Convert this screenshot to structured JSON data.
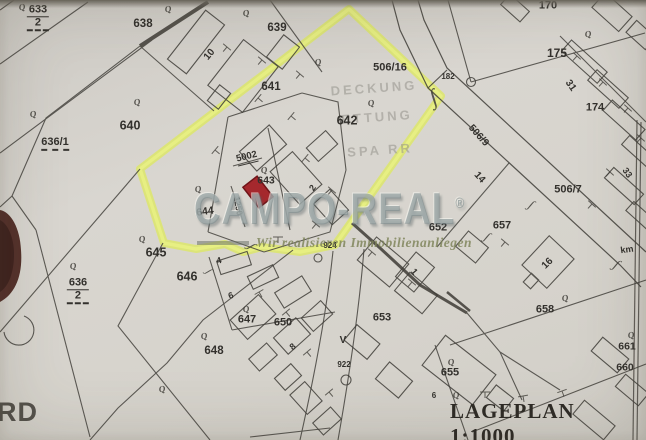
{
  "document": {
    "title": "LAGEPLAN 1:1000",
    "scale": "1:1000",
    "corner_text": "RD"
  },
  "watermark": {
    "brand": "CAMPO-REAL",
    "registered_mark": "®",
    "tagline": "Wir realisieren Immobilienanliegen"
  },
  "bleed_through_text": [
    "DECKUNG",
    "ETTUNG",
    "SPA RR"
  ],
  "highlight": {
    "outline_color": "#e3ef54",
    "marked_building_fill": "#a5282d",
    "marked_building_stroke": "#701519"
  },
  "map_labels": [
    {
      "text": "633/2",
      "x": 38,
      "y": 18,
      "stack": true,
      "fs": 11,
      "k": "parcel"
    },
    {
      "text": "638",
      "x": 143,
      "y": 25,
      "fs": 11.5,
      "k": "parcel"
    },
    {
      "text": "639",
      "x": 277,
      "y": 29,
      "fs": 11.5,
      "k": "parcel"
    },
    {
      "text": "640",
      "x": 130,
      "y": 126,
      "fs": 12.5,
      "k": "parcel"
    },
    {
      "text": "636/1",
      "x": 55,
      "y": 144,
      "fs": 11,
      "k": "parcel",
      "dash": true
    },
    {
      "text": "641",
      "x": 271,
      "y": 88,
      "fs": 11.5,
      "k": "parcel"
    },
    {
      "text": "506/16",
      "x": 390,
      "y": 68,
      "fs": 11,
      "k": "parcel"
    },
    {
      "text": "642",
      "x": 347,
      "y": 121,
      "fs": 12.5,
      "k": "parcel"
    },
    {
      "text": "643",
      "x": 266,
      "y": 181,
      "fs": 10.5,
      "k": "parcel"
    },
    {
      "text": "644",
      "x": 205,
      "y": 212,
      "fs": 10.5,
      "rot": -8,
      "k": "parcel"
    },
    {
      "text": "645",
      "x": 156,
      "y": 253,
      "fs": 12.5,
      "k": "parcel"
    },
    {
      "text": "646",
      "x": 187,
      "y": 277,
      "fs": 12.5,
      "k": "parcel"
    },
    {
      "text": "636/2",
      "x": 78,
      "y": 291,
      "stack": true,
      "fs": 11,
      "k": "parcel"
    },
    {
      "text": "647",
      "x": 247,
      "y": 320,
      "fs": 11,
      "k": "parcel"
    },
    {
      "text": "650",
      "x": 283,
      "y": 323,
      "fs": 11,
      "k": "parcel"
    },
    {
      "text": "648",
      "x": 214,
      "y": 352,
      "fs": 11.5,
      "k": "parcel"
    },
    {
      "text": "653",
      "x": 382,
      "y": 318,
      "fs": 11,
      "k": "parcel"
    },
    {
      "text": "655",
      "x": 450,
      "y": 373,
      "fs": 11,
      "k": "parcel"
    },
    {
      "text": "652",
      "x": 438,
      "y": 228,
      "fs": 11,
      "k": "parcel"
    },
    {
      "text": "657",
      "x": 502,
      "y": 226,
      "fs": 11,
      "k": "parcel"
    },
    {
      "text": "658",
      "x": 545,
      "y": 310,
      "fs": 11,
      "k": "parcel"
    },
    {
      "text": "661",
      "x": 627,
      "y": 347,
      "fs": 10.5,
      "k": "parcel"
    },
    {
      "text": "660",
      "x": 625,
      "y": 368,
      "fs": 10.5,
      "k": "parcel"
    },
    {
      "text": "170",
      "x": 548,
      "y": 6,
      "fs": 11,
      "k": "parcel"
    },
    {
      "text": "175",
      "x": 557,
      "y": 53,
      "fs": 12,
      "k": "parcel"
    },
    {
      "text": "174",
      "x": 595,
      "y": 108,
      "fs": 11,
      "k": "parcel"
    },
    {
      "text": "506/9",
      "x": 478,
      "y": 136,
      "fs": 10,
      "rot": 48,
      "k": "parcel"
    },
    {
      "text": "506/7",
      "x": 568,
      "y": 190,
      "fs": 11,
      "k": "parcel"
    },
    {
      "text": "10",
      "x": 210,
      "y": 55,
      "rot": -50,
      "fs": 10,
      "k": "bldg"
    },
    {
      "text": "31",
      "x": 570,
      "y": 86,
      "rot": 55,
      "fs": 10,
      "k": "bldg"
    },
    {
      "text": "33",
      "x": 627,
      "y": 173,
      "rot": 55,
      "fs": 9,
      "k": "bldg"
    },
    {
      "text": "14",
      "x": 479,
      "y": 178,
      "rot": 48,
      "fs": 10,
      "k": "bldg"
    },
    {
      "text": "2",
      "x": 313,
      "y": 188,
      "rot": -55,
      "fs": 9,
      "k": "bldg"
    },
    {
      "text": "5002",
      "x": 247,
      "y": 158,
      "rot": -14,
      "fs": 9.5,
      "k": "bldg",
      "unders": true
    },
    {
      "text": "1250",
      "x": 238,
      "y": 206,
      "rot": 80,
      "fs": 8.5,
      "k": "bldg"
    },
    {
      "text": "16",
      "x": 548,
      "y": 264,
      "rot": -45,
      "fs": 10,
      "k": "bldg"
    },
    {
      "text": "4",
      "x": 219,
      "y": 261,
      "rot": -15,
      "fs": 9,
      "k": "bldg"
    },
    {
      "text": "6",
      "x": 231,
      "y": 296,
      "rot": -20,
      "fs": 9,
      "k": "bldg"
    },
    {
      "text": "8",
      "x": 293,
      "y": 347,
      "rot": -40,
      "fs": 9,
      "k": "bldg"
    },
    {
      "text": "1",
      "x": 414,
      "y": 272,
      "rot": 50,
      "fs": 9,
      "k": "bldg"
    },
    {
      "text": "6",
      "x": 434,
      "y": 396,
      "fs": 8,
      "k": "bldg"
    },
    {
      "text": "182",
      "x": 448,
      "y": 77,
      "fs": 8,
      "k": "small"
    },
    {
      "text": "924",
      "x": 330,
      "y": 246,
      "fs": 8,
      "k": "small"
    },
    {
      "text": "922",
      "x": 344,
      "y": 365,
      "fs": 8,
      "k": "small"
    },
    {
      "text": "V",
      "x": 343,
      "y": 341,
      "fs": 10,
      "k": "small"
    },
    {
      "text": "km",
      "x": 627,
      "y": 250,
      "fs": 9,
      "rot": -8,
      "k": "small"
    }
  ],
  "tree_symbols": [
    [
      22,
      7
    ],
    [
      168,
      9
    ],
    [
      246,
      13
    ],
    [
      318,
      62
    ],
    [
      371,
      103
    ],
    [
      588,
      34
    ],
    [
      137,
      102
    ],
    [
      33,
      114
    ],
    [
      198,
      189
    ],
    [
      264,
      170
    ],
    [
      142,
      239
    ],
    [
      73,
      266
    ],
    [
      246,
      309
    ],
    [
      204,
      336
    ],
    [
      162,
      389
    ],
    [
      451,
      362
    ],
    [
      565,
      298
    ],
    [
      631,
      335
    ],
    [
      456,
      395
    ]
  ]
}
